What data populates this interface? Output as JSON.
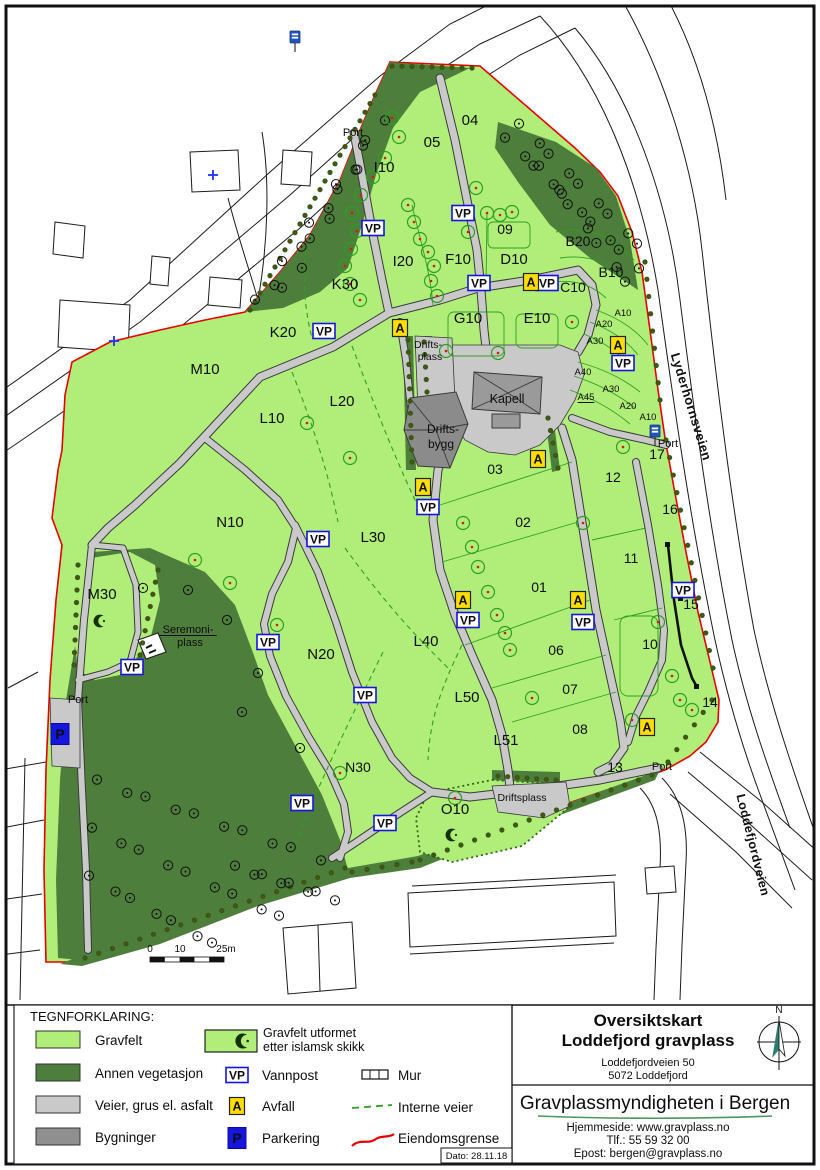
{
  "colors": {
    "gravfelt": "#b0ee79",
    "vegetation": "#4e7e3b",
    "road": "#c9c9c9",
    "building": "#8f8f8f",
    "boundary_red": "#e60000",
    "interne_green": "#2f9e20",
    "vp_blue": "#1515dd",
    "avfall_yellow": "#ffdd00",
    "authority_green": "#2e8540"
  },
  "map": {
    "field_labels": [
      {
        "t": "04",
        "x": 470,
        "y": 125,
        "s": 15
      },
      {
        "t": "05",
        "x": 432,
        "y": 147,
        "s": 15
      },
      {
        "t": "I10",
        "x": 384,
        "y": 172,
        "s": 15
      },
      {
        "t": "09",
        "x": 505,
        "y": 234,
        "s": 14
      },
      {
        "t": "B20",
        "x": 578,
        "y": 246,
        "s": 14
      },
      {
        "t": "I20",
        "x": 403,
        "y": 266,
        "s": 15
      },
      {
        "t": "F10",
        "x": 458,
        "y": 264,
        "s": 15
      },
      {
        "t": "D10",
        "x": 514,
        "y": 264,
        "s": 15
      },
      {
        "t": "B10",
        "x": 611,
        "y": 277,
        "s": 14
      },
      {
        "t": "C10",
        "x": 573,
        "y": 292,
        "s": 14
      },
      {
        "t": "K30",
        "x": 345,
        "y": 289,
        "s": 15
      },
      {
        "t": "K20",
        "x": 283,
        "y": 337,
        "s": 15
      },
      {
        "t": "G10",
        "x": 468,
        "y": 323,
        "s": 15
      },
      {
        "t": "E10",
        "x": 537,
        "y": 323,
        "s": 15
      },
      {
        "t": "M10",
        "x": 205,
        "y": 374,
        "s": 15
      },
      {
        "t": "L20",
        "x": 342,
        "y": 406,
        "s": 15
      },
      {
        "t": "L10",
        "x": 272,
        "y": 423,
        "s": 15
      },
      {
        "t": "L30",
        "x": 373,
        "y": 542,
        "s": 15
      },
      {
        "t": "N10",
        "x": 230,
        "y": 527,
        "s": 15
      },
      {
        "t": "L40",
        "x": 426,
        "y": 646,
        "s": 15
      },
      {
        "t": "N20",
        "x": 321,
        "y": 659,
        "s": 15
      },
      {
        "t": "L50",
        "x": 467,
        "y": 702,
        "s": 15
      },
      {
        "t": "L51",
        "x": 506,
        "y": 745,
        "s": 15
      },
      {
        "t": "N30",
        "x": 358,
        "y": 772,
        "s": 14
      },
      {
        "t": "M30",
        "x": 102,
        "y": 599,
        "s": 15
      },
      {
        "t": "O10",
        "x": 455,
        "y": 814,
        "s": 15
      },
      {
        "t": "03",
        "x": 495,
        "y": 474,
        "s": 14
      },
      {
        "t": "02",
        "x": 523,
        "y": 527,
        "s": 14
      },
      {
        "t": "01",
        "x": 539,
        "y": 592,
        "s": 14
      },
      {
        "t": "06",
        "x": 556,
        "y": 655,
        "s": 14
      },
      {
        "t": "07",
        "x": 570,
        "y": 694,
        "s": 14
      },
      {
        "t": "08",
        "x": 580,
        "y": 734,
        "s": 14
      },
      {
        "t": "10",
        "x": 650,
        "y": 649,
        "s": 14
      },
      {
        "t": "11",
        "x": 631,
        "y": 563,
        "s": 14
      },
      {
        "t": "12",
        "x": 613,
        "y": 482,
        "s": 14
      },
      {
        "t": "13",
        "x": 615,
        "y": 772,
        "s": 14
      },
      {
        "t": "14",
        "x": 710,
        "y": 707,
        "s": 14
      },
      {
        "t": "15",
        "x": 691,
        "y": 609,
        "s": 14
      },
      {
        "t": "16",
        "x": 670,
        "y": 514,
        "s": 14
      },
      {
        "t": "17",
        "x": 657,
        "y": 459,
        "s": 14
      },
      {
        "t": "A10",
        "x": 623,
        "y": 316,
        "s": 9.5
      },
      {
        "t": "A20",
        "x": 604,
        "y": 327,
        "s": 9.5
      },
      {
        "t": "A30",
        "x": 595,
        "y": 344,
        "s": 9.5
      },
      {
        "t": "A40",
        "x": 583,
        "y": 375,
        "s": 9.5
      },
      {
        "t": "A45",
        "x": 586,
        "y": 400,
        "s": 9.5,
        "u": 1
      },
      {
        "t": "A30",
        "x": 611,
        "y": 392,
        "s": 9.5
      },
      {
        "t": "A20",
        "x": 628,
        "y": 409,
        "s": 9.5
      },
      {
        "t": "A10",
        "x": 648,
        "y": 420,
        "s": 9.5
      }
    ],
    "area_labels": [
      {
        "t": "Kapell",
        "x": 507,
        "y": 403,
        "s": 12.5
      },
      {
        "t": "Drifts-",
        "x": 443,
        "y": 433,
        "s": 12
      },
      {
        "t": "bygg",
        "x": 441,
        "y": 448,
        "s": 12
      },
      {
        "t": "Drifts-",
        "x": 428,
        "y": 348,
        "s": 10.5
      },
      {
        "t": "plass",
        "x": 430,
        "y": 360,
        "s": 10.5
      },
      {
        "t": "Driftsplass",
        "x": 522,
        "y": 801,
        "s": 10.5
      },
      {
        "t": "Seremoni-",
        "x": 188,
        "y": 633,
        "s": 11,
        "u": 1
      },
      {
        "t": "plass",
        "x": 190,
        "y": 646,
        "s": 11
      },
      {
        "t": "Port",
        "x": 353,
        "y": 136,
        "s": 11
      },
      {
        "t": "Port",
        "x": 668,
        "y": 447,
        "s": 11
      },
      {
        "t": "Port",
        "x": 78,
        "y": 703,
        "s": 11
      },
      {
        "t": "Port",
        "x": 662,
        "y": 770,
        "s": 11
      }
    ],
    "street_labels": [
      {
        "t": "Lyderhornsveien",
        "x": 687,
        "y": 408,
        "r": 73,
        "s": 13
      },
      {
        "t": "Loddefjordveien",
        "x": 749,
        "y": 846,
        "r": 76,
        "s": 12.5
      }
    ],
    "marker_text": {
      "vp": "VP",
      "a": "A",
      "p": "P"
    },
    "vp_markers": [
      [
        373,
        228
      ],
      [
        463,
        213
      ],
      [
        479,
        283
      ],
      [
        547,
        283
      ],
      [
        324,
        331
      ],
      [
        623,
        363
      ],
      [
        318,
        539
      ],
      [
        428,
        507
      ],
      [
        468,
        620
      ],
      [
        583,
        622
      ],
      [
        268,
        642
      ],
      [
        132,
        667
      ],
      [
        365,
        695
      ],
      [
        302,
        803
      ],
      [
        385,
        823
      ],
      [
        683,
        590
      ]
    ],
    "a_markers": [
      [
        531,
        282
      ],
      [
        400,
        328
      ],
      [
        618,
        345
      ],
      [
        538,
        459
      ],
      [
        423,
        487
      ],
      [
        463,
        600
      ],
      [
        578,
        600
      ],
      [
        647,
        727
      ]
    ],
    "p_markers": [
      [
        60,
        734
      ]
    ],
    "bus_stops": [
      [
        295,
        37
      ],
      [
        655,
        431
      ]
    ],
    "crosses": [
      [
        213,
        175
      ],
      [
        114,
        341
      ]
    ],
    "crescents": [
      [
        100,
        621
      ],
      [
        452,
        835
      ]
    ],
    "trees_field": [
      [
        392,
        118
      ],
      [
        399,
        137
      ],
      [
        385,
        158
      ],
      [
        373,
        177
      ],
      [
        361,
        195
      ],
      [
        352,
        213
      ],
      [
        357,
        231
      ],
      [
        351,
        249
      ],
      [
        345,
        266
      ],
      [
        350,
        284
      ],
      [
        360,
        300
      ],
      [
        476,
        188
      ],
      [
        487,
        213
      ],
      [
        500,
        215
      ],
      [
        512,
        212
      ],
      [
        468,
        232
      ],
      [
        408,
        205
      ],
      [
        414,
        222
      ],
      [
        420,
        239
      ],
      [
        428,
        252
      ],
      [
        434,
        266
      ],
      [
        431,
        281
      ],
      [
        437,
        296
      ],
      [
        446,
        351
      ],
      [
        498,
        353
      ],
      [
        572,
        322
      ],
      [
        463,
        523
      ],
      [
        472,
        547
      ],
      [
        478,
        567
      ],
      [
        488,
        592
      ],
      [
        497,
        615
      ],
      [
        505,
        633
      ],
      [
        510,
        650
      ],
      [
        583,
        523
      ],
      [
        623,
        447
      ],
      [
        658,
        622
      ],
      [
        672,
        676
      ],
      [
        532,
        698
      ],
      [
        632,
        720
      ],
      [
        307,
        423
      ],
      [
        350,
        458
      ],
      [
        195,
        560
      ],
      [
        230,
        583
      ],
      [
        277,
        625
      ],
      [
        340,
        773
      ],
      [
        455,
        798
      ],
      [
        680,
        700
      ],
      [
        692,
        710
      ]
    ],
    "trees_forest": [
      [
        143,
        588
      ],
      [
        188,
        590
      ],
      [
        227,
        620
      ],
      [
        258,
        673
      ],
      [
        242,
        712
      ],
      [
        300,
        748
      ],
      [
        262,
        640
      ]
    ],
    "forest_rows": [
      {
        "f": [
          258,
          302
        ],
        "g": [
          366,
          148
        ],
        "n": 9
      },
      {
        "f": [
          285,
          290
        ],
        "g": [
          382,
          118
        ],
        "n": 8
      },
      {
        "f": [
          508,
          140
        ],
        "g": [
          636,
          266
        ],
        "n": 10
      },
      {
        "f": [
          522,
          126
        ],
        "g": [
          640,
          246
        ],
        "n": 9
      },
      {
        "f": [
          542,
          168
        ],
        "g": [
          628,
          284
        ],
        "n": 7
      },
      {
        "f": [
          100,
          782
        ],
        "g": [
          318,
          858
        ],
        "n": 10
      },
      {
        "f": [
          95,
          830
        ],
        "g": [
          282,
          918
        ],
        "n": 9
      },
      {
        "f": [
          92,
          878
        ],
        "g": [
          215,
          945
        ],
        "n": 7
      },
      {
        "f": [
          238,
          868
        ],
        "g": [
          332,
          898
        ],
        "n": 8
      }
    ],
    "hedge_rows": [
      {
        "f": [
          375,
          95
        ],
        "g": [
          250,
          310
        ],
        "n": 26
      },
      {
        "f": [
          392,
          66
        ],
        "g": [
          472,
          68
        ],
        "n": 9
      },
      {
        "f": [
          645,
          262
        ],
        "g": [
          660,
          400
        ],
        "n": 9
      },
      {
        "f": [
          666,
          440
        ],
        "g": [
          713,
          668
        ],
        "n": 14
      },
      {
        "f": [
          712,
          700
        ],
        "g": [
          668,
          762
        ],
        "n": 6
      },
      {
        "f": [
          652,
          775
        ],
        "g": [
          420,
          860
        ],
        "n": 18
      },
      {
        "f": [
          412,
          862
        ],
        "g": [
          352,
          872
        ],
        "n": 5
      },
      {
        "f": [
          408,
          340
        ],
        "g": [
          412,
          462
        ],
        "n": 11
      },
      {
        "f": [
          424,
          342
        ],
        "g": [
          427,
          392
        ],
        "n": 5
      },
      {
        "f": [
          548,
          418
        ],
        "g": [
          558,
          468
        ],
        "n": 5
      },
      {
        "f": [
          498,
          776
        ],
        "g": [
          556,
          780
        ],
        "n": 7
      },
      {
        "f": [
          345,
          868
        ],
        "g": [
          85,
          958
        ],
        "n": 20
      },
      {
        "f": [
          78,
          565
        ],
        "g": [
          74,
          665
        ],
        "n": 9
      },
      {
        "f": [
          158,
          570
        ],
        "g": [
          140,
          655
        ],
        "n": 8
      }
    ],
    "scalebar": {
      "l0": "0",
      "l10": "10",
      "l25": "25m"
    }
  },
  "legend": {
    "heading": "TEGNFORKLARING:",
    "items": [
      {
        "label": "Gravfelt"
      },
      {
        "label": "Annen vegetasjon"
      },
      {
        "label": "Veier, grus el. asfalt"
      },
      {
        "label": "Bygninger"
      }
    ],
    "islamic_line1": "Gravfelt utformet",
    "islamic_line2": "etter islamsk skikk",
    "vannpost": "Vannpost",
    "avfall": "Avfall",
    "parkering": "Parkering",
    "mur": "Mur",
    "interne": "Interne veier",
    "eiendom": "Eiendomsgrense",
    "dato": "Dato: 28.11.18"
  },
  "title_block": {
    "line1": "Oversiktskart",
    "line2": "Loddefjord gravplass",
    "addr1": "Loddefjordveien 50",
    "addr2": "5072  Loddefjord",
    "authority": "Gravplassmyndigheten i Bergen",
    "web": "Hjemmeside: www.gravplass.no",
    "tel": "Tlf.: 55 59 32 00",
    "email": "Epost: bergen@gravplass.no",
    "compass_n": "N"
  }
}
